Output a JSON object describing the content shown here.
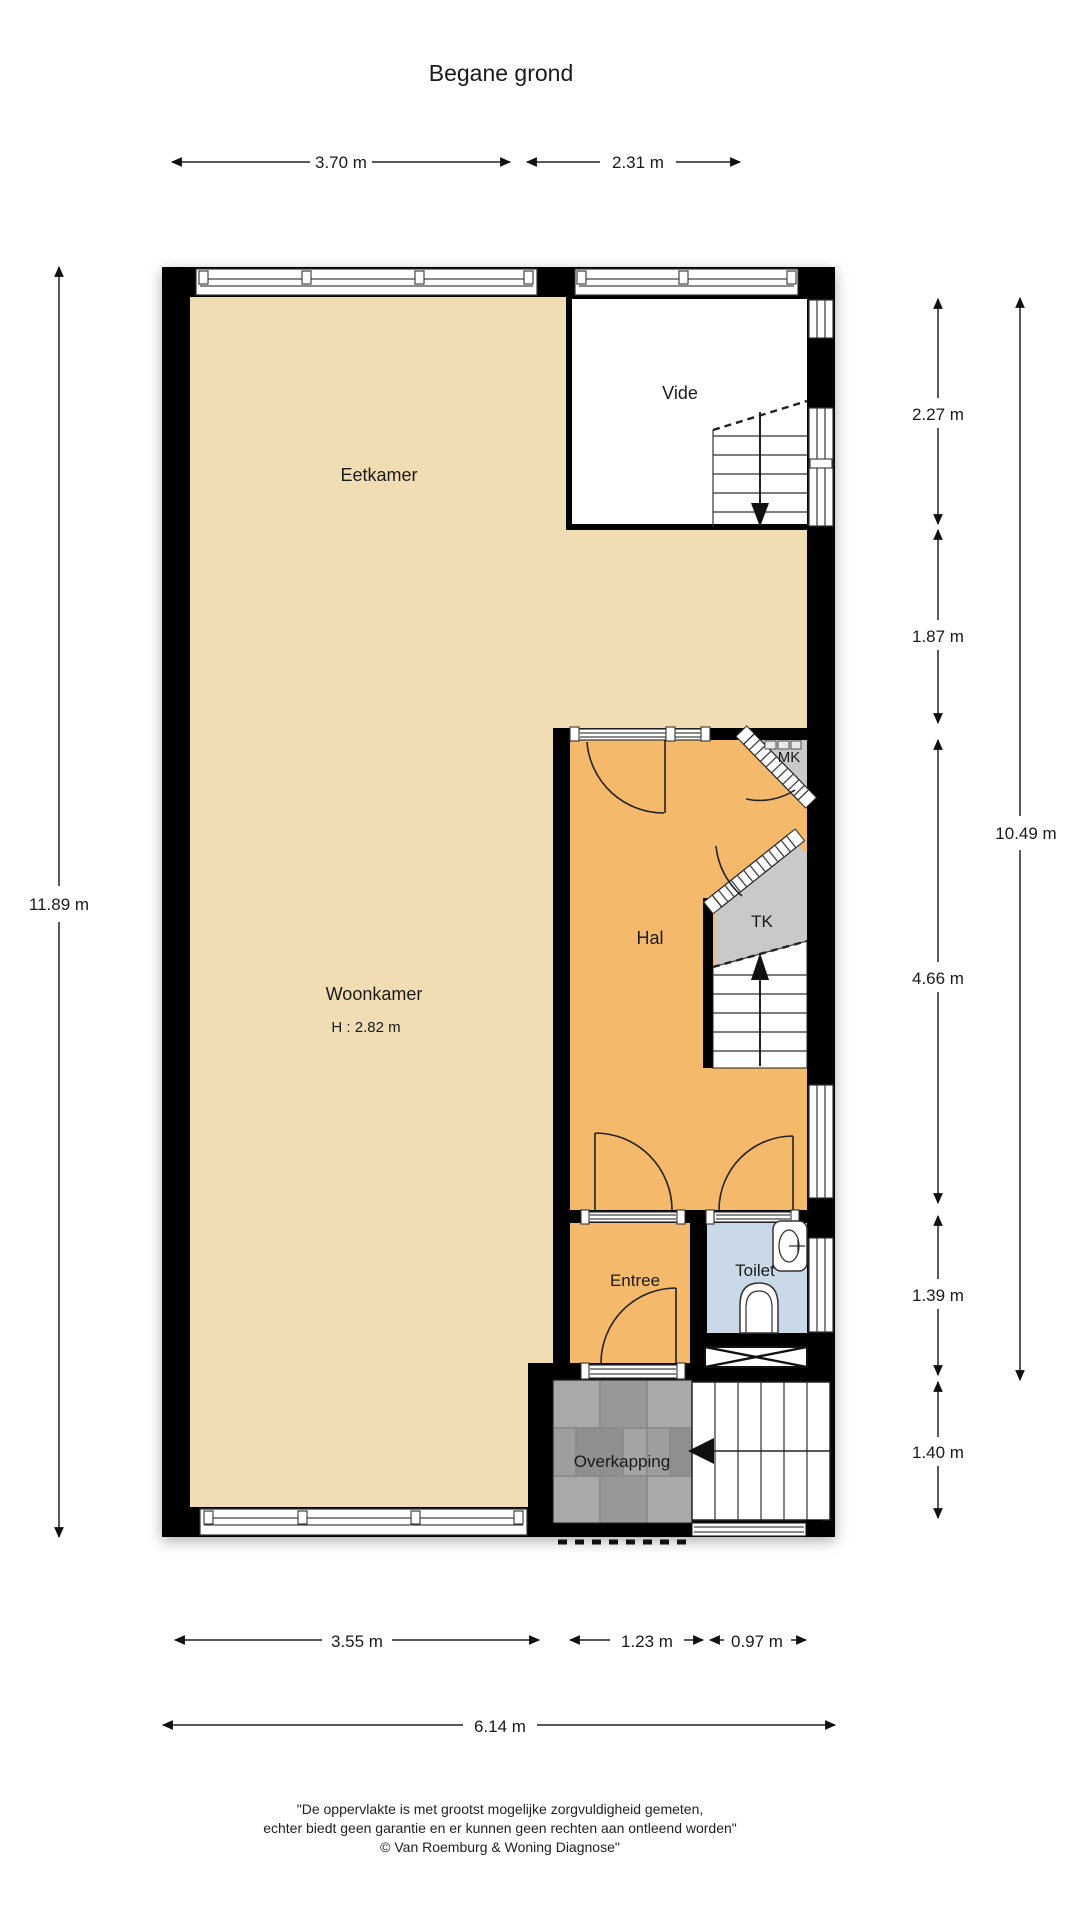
{
  "title": "Begane grond",
  "colors": {
    "wall": "#000000",
    "floor_tan": "#F1DDB4",
    "floor_orange": "#F5B96B",
    "floor_blue": "#C9D9E8",
    "closet_gray": "#C9C9C9",
    "paving_base": "#8C8C8C",
    "text": "#1A1A1A"
  },
  "rooms": {
    "eetkamer": "Eetkamer",
    "vide": "Vide",
    "woonkamer": "Woonkamer",
    "woonkamer_height": "H : 2.82 m",
    "hal": "Hal",
    "tk": "TK",
    "mk": "MK",
    "entree": "Entree",
    "toilet": "Toilet",
    "overkapping": "Overkapping"
  },
  "dimensions": {
    "top_w1": "3.70 m",
    "top_w2": "2.31 m",
    "left_total": "11.89 m",
    "right_1": "2.27 m",
    "right_2": "1.87 m",
    "right_total": "10.49 m",
    "right_3": "4.66 m",
    "right_4": "1.39 m",
    "right_5": "1.40 m",
    "bottom_1": "3.55 m",
    "bottom_2": "1.23 m",
    "bottom_3": "0.97 m",
    "bottom_total": "6.14 m"
  },
  "footer": {
    "line1": "\"De oppervlakte is met grootst mogelijke zorgvuldigheid gemeten,",
    "line2": "echter biedt geen garantie en er kunnen geen rechten aan ontleend worden\"",
    "line3": "© Van Roemburg & Woning Diagnose\""
  }
}
